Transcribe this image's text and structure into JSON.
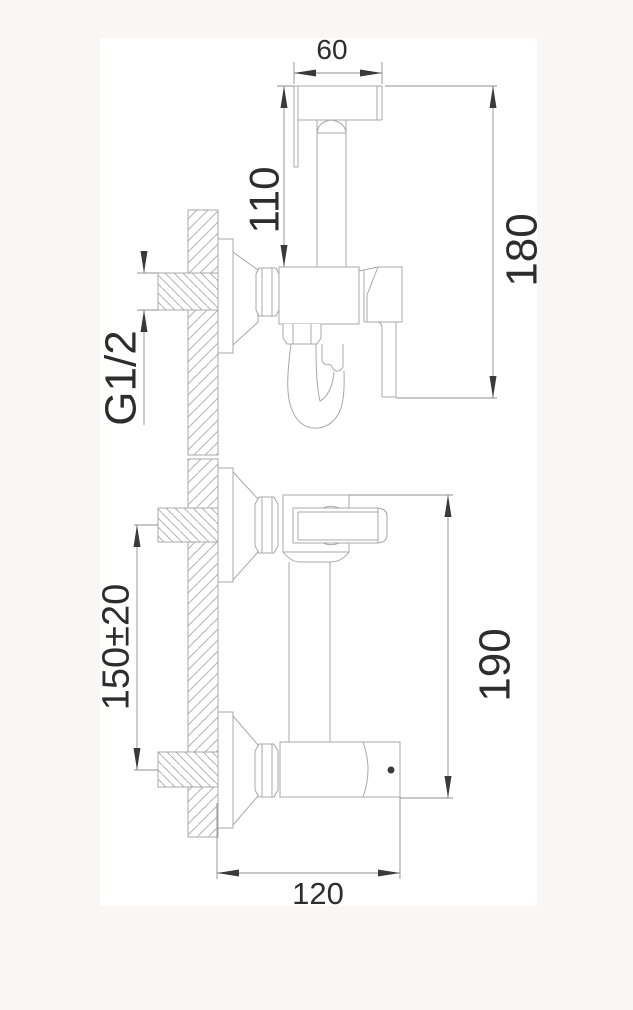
{
  "page": {
    "background_color": "#f8f7f4",
    "canvas_color": "#ffffff",
    "line_color": "#a8a8a8",
    "dimension_line_color": "#8f8f8f",
    "text_color": "#2d2d2d"
  },
  "dimensions": {
    "head_width": {
      "label": "60"
    },
    "handle_height": {
      "label": "110"
    },
    "total_height": {
      "label": "180"
    },
    "thread": {
      "label": "G1/2"
    },
    "pipe_spacing": {
      "label": "150±20"
    },
    "body_height": {
      "label": "190"
    },
    "body_width": {
      "label": "120"
    }
  }
}
